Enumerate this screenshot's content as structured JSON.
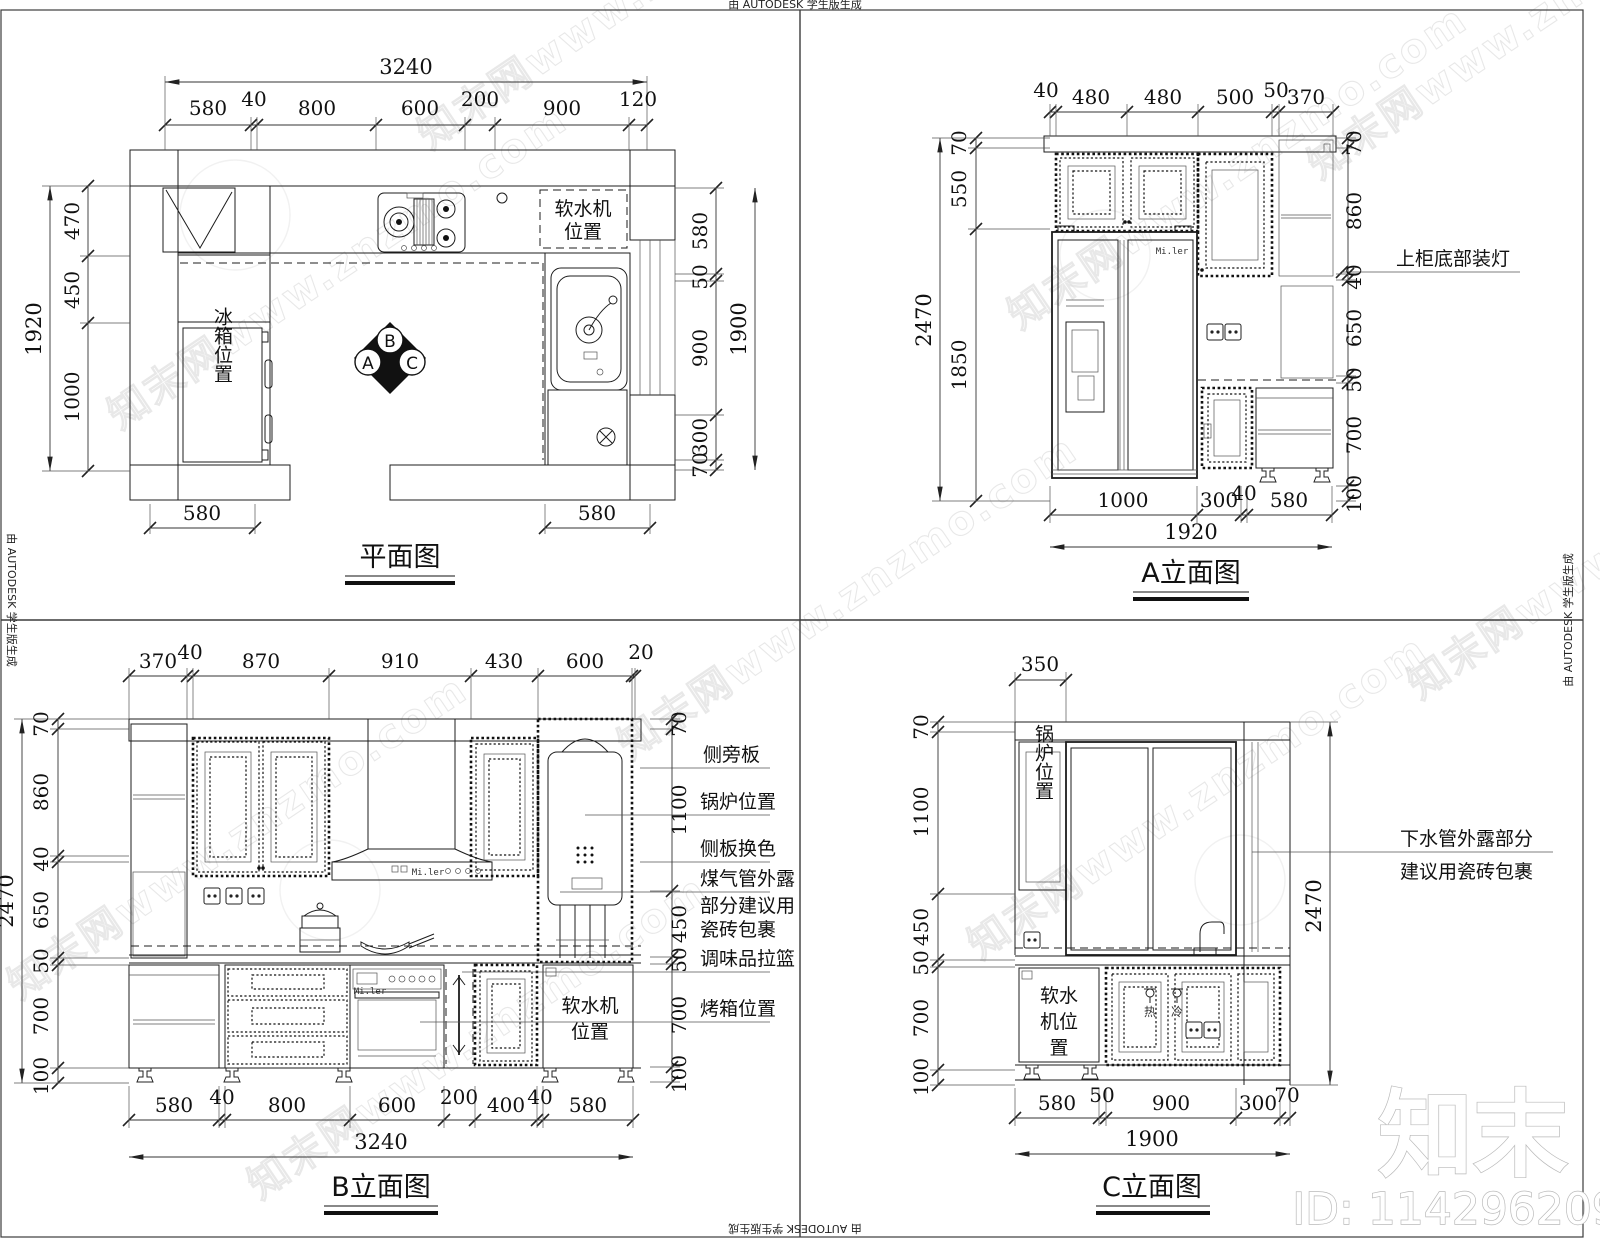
{
  "page": {
    "credit": "由 AUTODESK 学生版生成",
    "watermark": "知末网www.znzmo.com",
    "logo": "知末",
    "id": "ID: 1142962099",
    "brand": "Mi.ler"
  },
  "plan": {
    "title": "平面图",
    "top_total": "3240",
    "top": [
      "580",
      "40",
      "800",
      "600",
      "200",
      "900",
      "120"
    ],
    "left_total": "1920",
    "left": [
      "470",
      "450",
      "1000"
    ],
    "right_total": "1900",
    "right": [
      "580",
      "50",
      "900",
      "300",
      "70"
    ],
    "bottom_left": "580",
    "bottom_right": "580",
    "softener1": "软水机",
    "softener2": "位置",
    "fridge": "冰箱位置",
    "mk_a": "A",
    "mk_b": "B",
    "mk_c": "C"
  },
  "eleva": {
    "title": "A立面图",
    "top": [
      "40",
      "480",
      "480",
      "500",
      "50",
      "370"
    ],
    "left_total": "2470",
    "left": [
      "70",
      "550",
      "1850"
    ],
    "right": [
      "70",
      "860",
      "40",
      "650",
      "50",
      "700",
      "100"
    ],
    "bottom": [
      "1000",
      "300",
      "40",
      "580"
    ],
    "bottom_total": "1920",
    "note": "上柜底部装灯"
  },
  "elevb": {
    "title": "B立面图",
    "top": [
      "370",
      "40",
      "870",
      "910",
      "430",
      "600",
      "20"
    ],
    "left_total": "2470",
    "left": [
      "70",
      "860",
      "40",
      "650",
      "50",
      "700",
      "100"
    ],
    "right": [
      "70",
      "1100",
      "450",
      "50",
      "700",
      "100"
    ],
    "bottom": [
      "580",
      "40",
      "800",
      "600",
      "200",
      "400",
      "40",
      "580"
    ],
    "bottom_total": "3240",
    "notes": [
      "侧旁板",
      "锅炉位置",
      "侧板换色",
      "煤气管外露",
      "部分建议用",
      "瓷砖包裹",
      "调味品拉篮",
      "烤箱位置"
    ],
    "softener1": "软水机",
    "softener2": "位置"
  },
  "elevc": {
    "title": "C立面图",
    "top": "350",
    "left": [
      "70",
      "1100",
      "450",
      "50",
      "700",
      "100"
    ],
    "right_total": "2470",
    "bottom": [
      "580",
      "50",
      "900",
      "300",
      "70"
    ],
    "bottom_total": "1900",
    "notes": [
      "下水管外露部分",
      "建议用瓷砖包裹"
    ],
    "boiler": "锅炉位置",
    "softener": [
      "软水",
      "机位",
      "置"
    ],
    "hot": "热",
    "cold": "冷"
  }
}
